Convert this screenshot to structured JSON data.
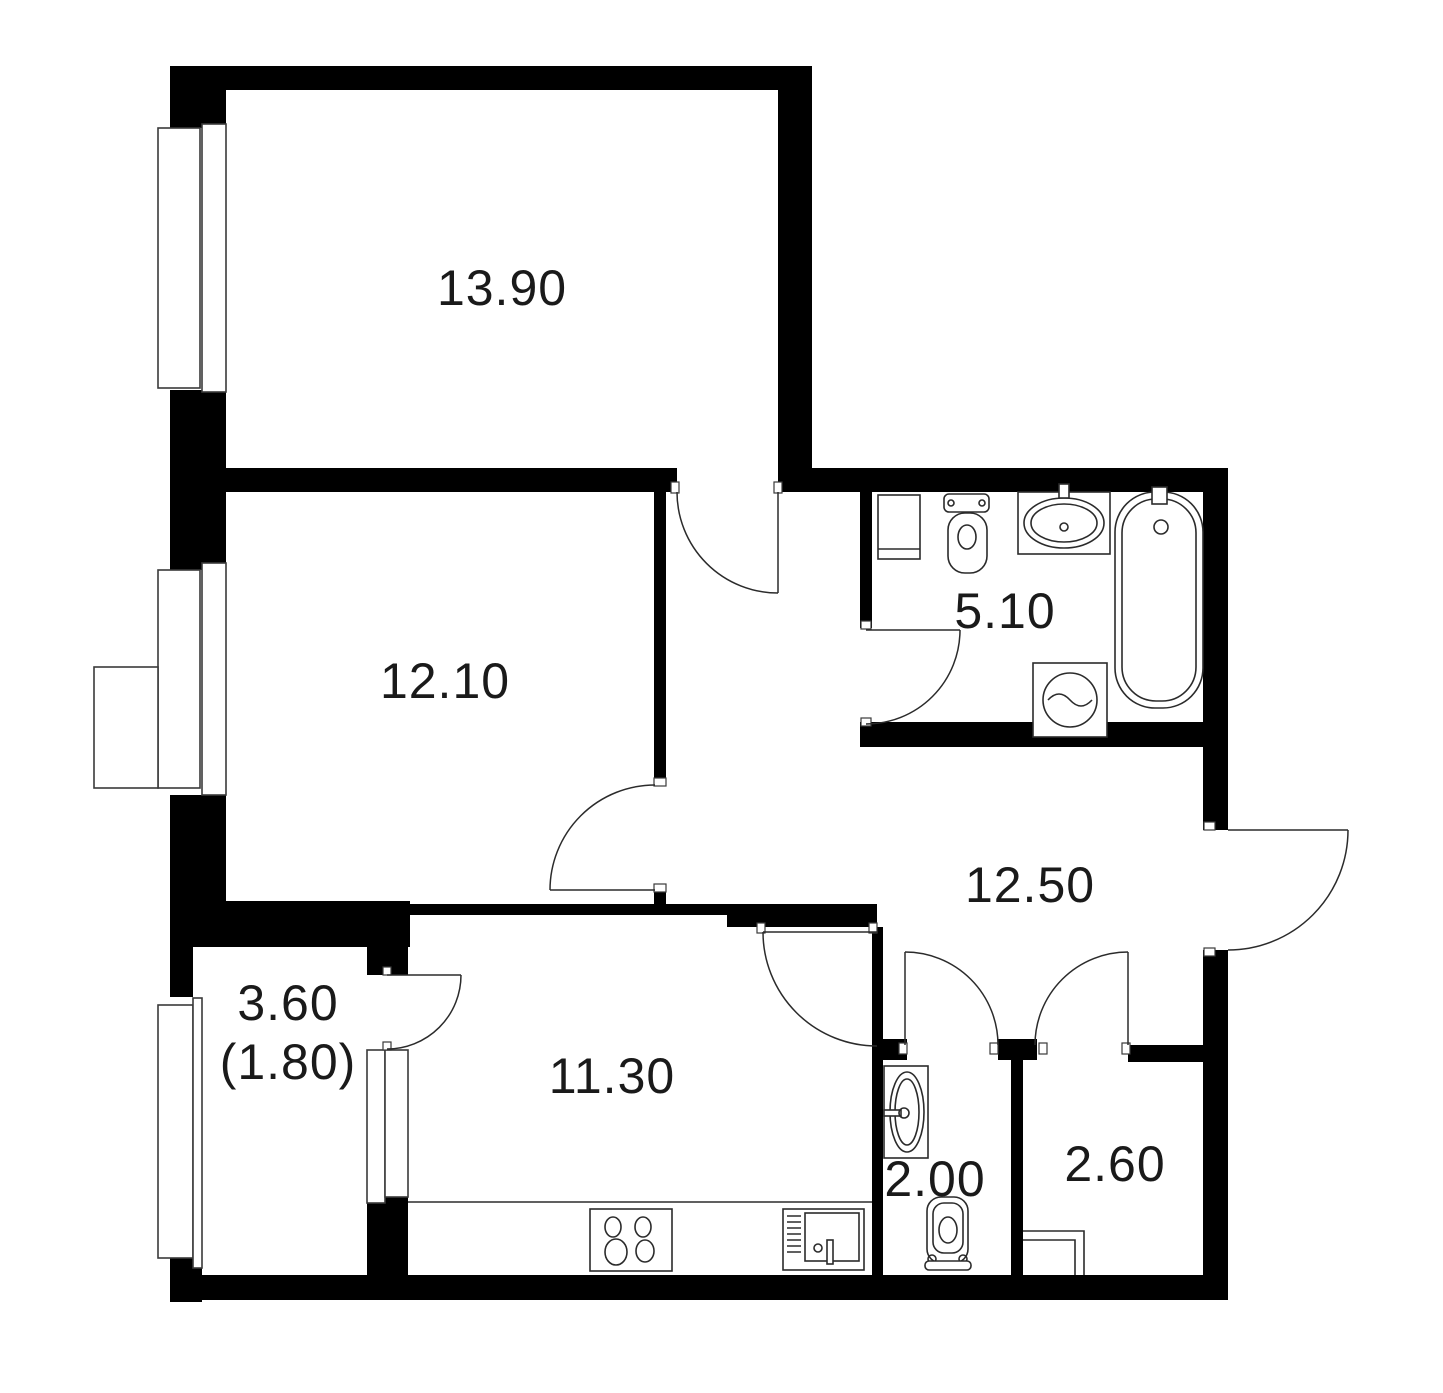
{
  "floor_plan": {
    "type": "apartment-floor-plan",
    "rooms": [
      {
        "name": "bedroom-1",
        "area_label": "13.90"
      },
      {
        "name": "bedroom-2",
        "area_label": "12.10"
      },
      {
        "name": "bathroom",
        "area_label": "5.10"
      },
      {
        "name": "hallway",
        "area_label": "12.50"
      },
      {
        "name": "kitchen",
        "area_label": "11.30"
      },
      {
        "name": "balcony",
        "area_label": "3.60",
        "area_label_secondary": "(1.80)"
      },
      {
        "name": "wc",
        "area_label": "2.00"
      },
      {
        "name": "storage",
        "area_label": "2.60"
      }
    ],
    "fixtures": [
      "toilet",
      "washbasin",
      "bathtub",
      "washing-machine",
      "shelf",
      "stove-hob",
      "kitchen-sink",
      "wc-washbasin",
      "wc-toilet",
      "vent-duct"
    ],
    "doors": [
      "bedroom-1-door",
      "bedroom-2-door",
      "bathroom-door",
      "kitchen-door",
      "wc-door",
      "storage-door",
      "balcony-door",
      "entrance-door"
    ],
    "windows": [
      "bedroom-1-window",
      "bedroom-2-window",
      "balcony-window",
      "balcony-block-window"
    ],
    "colors": {
      "walls": "#000000",
      "lines": "#2b2b2b",
      "background": "#ffffff",
      "text": "#1a1a1a"
    }
  }
}
